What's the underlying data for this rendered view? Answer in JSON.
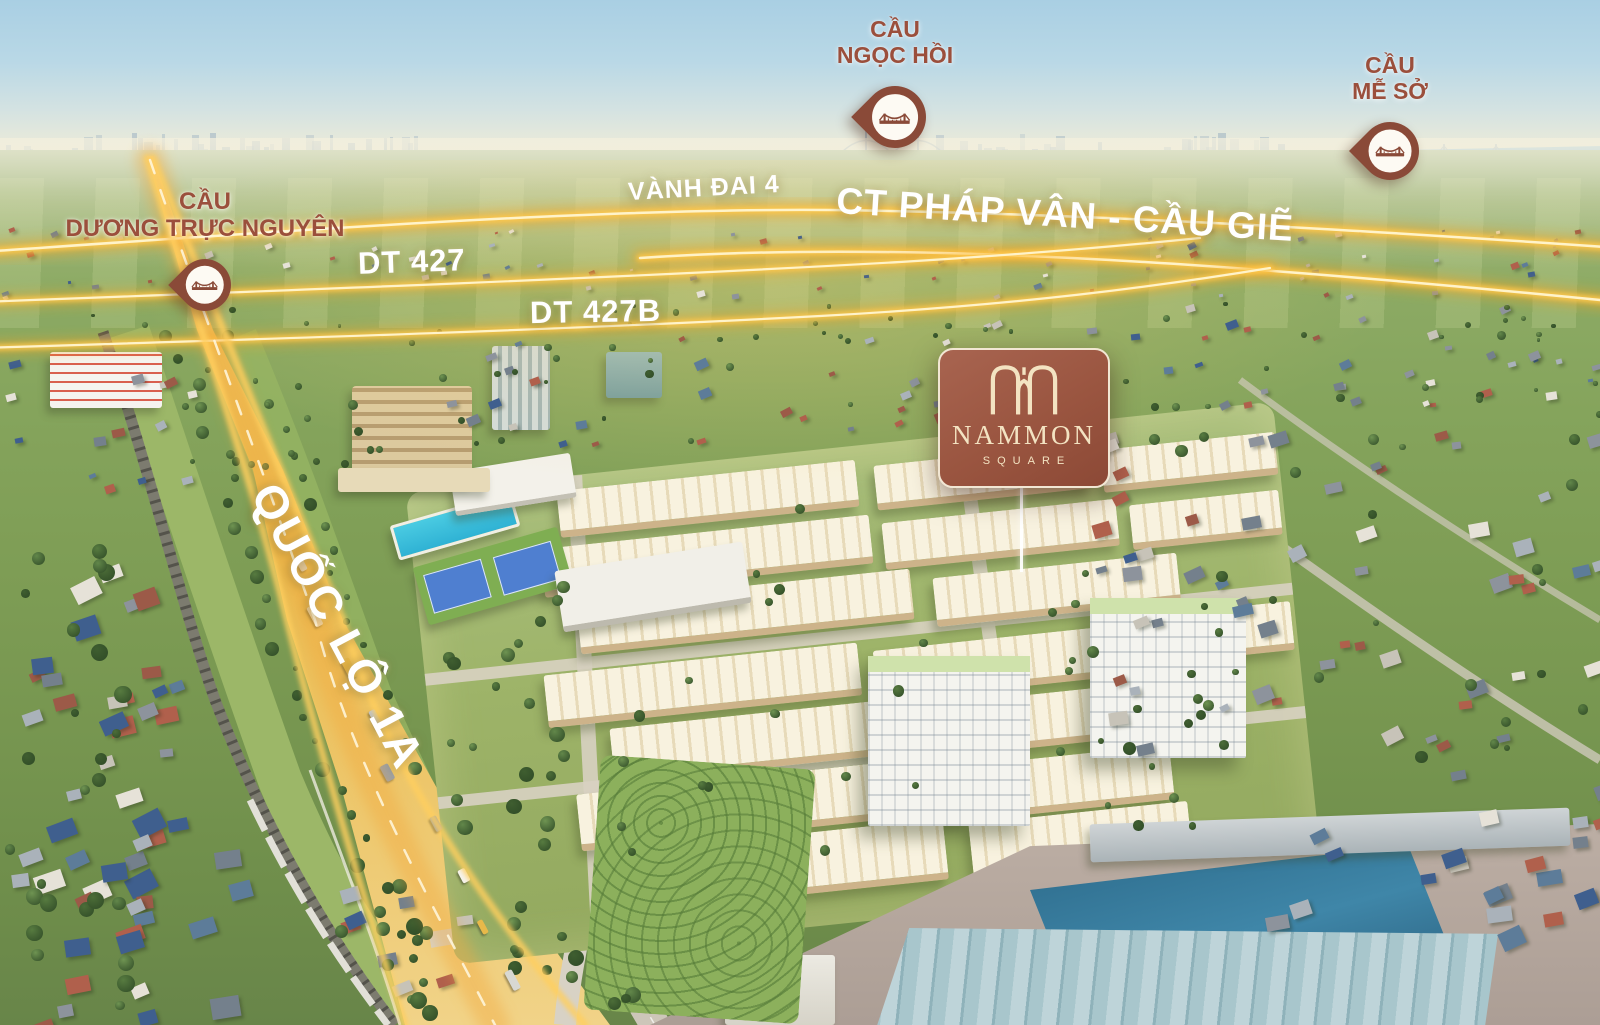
{
  "markers": [
    {
      "id": "cau-ngoc-hoi",
      "line1": "CẦU",
      "line2": "NGỌC HỒI"
    },
    {
      "id": "cau-me-so",
      "line1": "CẦU",
      "line2": "MỄ SỞ"
    },
    {
      "id": "cau-duong-truc-nguyen",
      "line1": "CẦU",
      "line2": "DƯƠNG TRỰC NGUYÊN"
    }
  ],
  "road_labels": {
    "vanh_dai_4": "VÀNH ĐAI 4",
    "ct_phap_van_cau_gie": "CT PHÁP VÂN - CẦU GIẼ",
    "dt_427": "DT 427",
    "dt_427b": "DT 427B",
    "quoc_lo_1a": "QUỐC LỘ 1A"
  },
  "project_badge": {
    "name": "NAMMON",
    "subtitle": "SQUARE"
  },
  "colors": {
    "marker_pin": "#8a4a38",
    "marker_text": "#9b4f3c",
    "road_glow": "#ffc94d",
    "road_surface": "#e9bb50",
    "badge_background": "#9a5540",
    "badge_border": "#f2e7d4",
    "badge_text": "#f3e3c2",
    "road_label_text": "#ffffff"
  }
}
